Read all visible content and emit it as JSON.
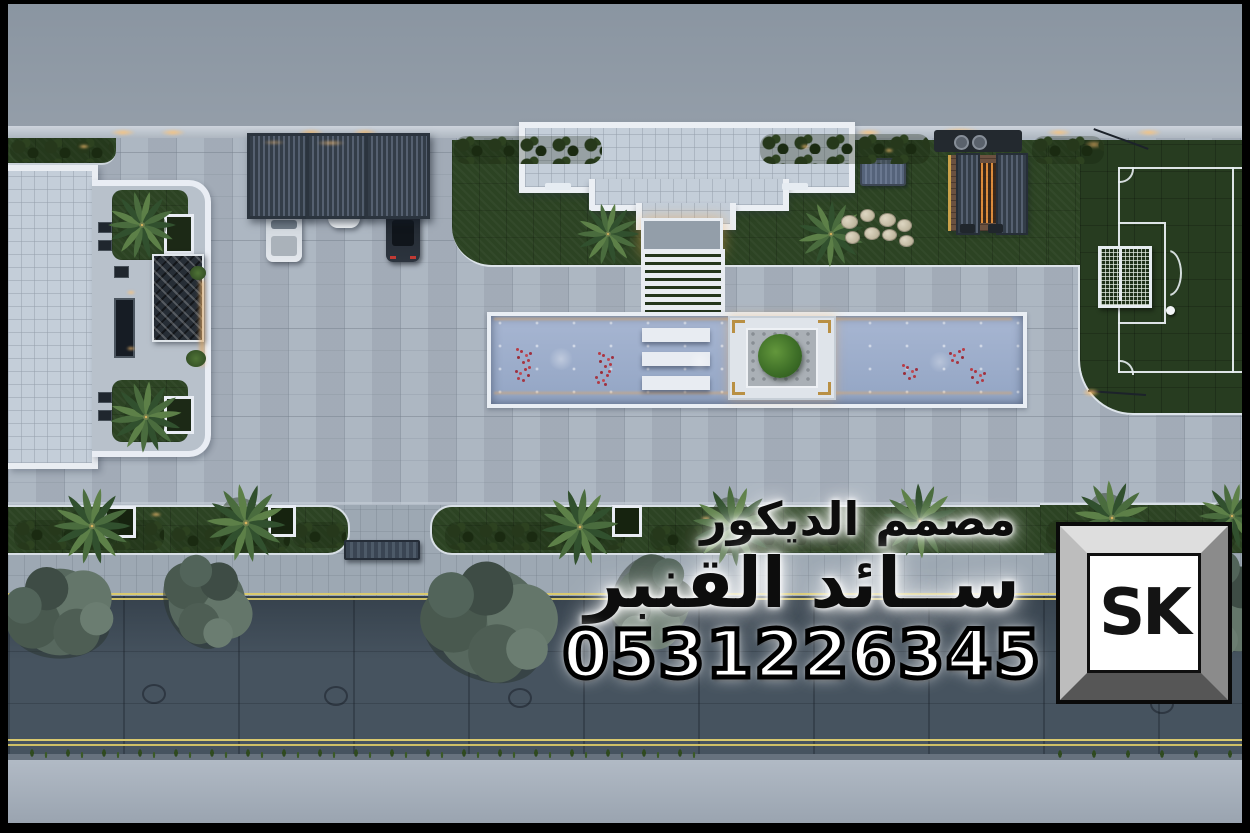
{
  "watermark": {
    "title_line": "مصمم الديكور",
    "name_line": "ســائد القنبر",
    "phone": "0531226345"
  },
  "logo": {
    "text": "SK"
  },
  "palette": {
    "top_band": "#8e98a4",
    "paving": "#a9b3bf",
    "lawn": "#2c4323",
    "field_grass": "#273c20",
    "water": "#9cadc9",
    "road": "#46535f",
    "road_line_yellow": "#d9c96e",
    "white_trim": "#e9eef4",
    "canopy_dark": "#39434e",
    "wood_deck": "#6b5140",
    "bottom_band": "#a8b1bc"
  }
}
